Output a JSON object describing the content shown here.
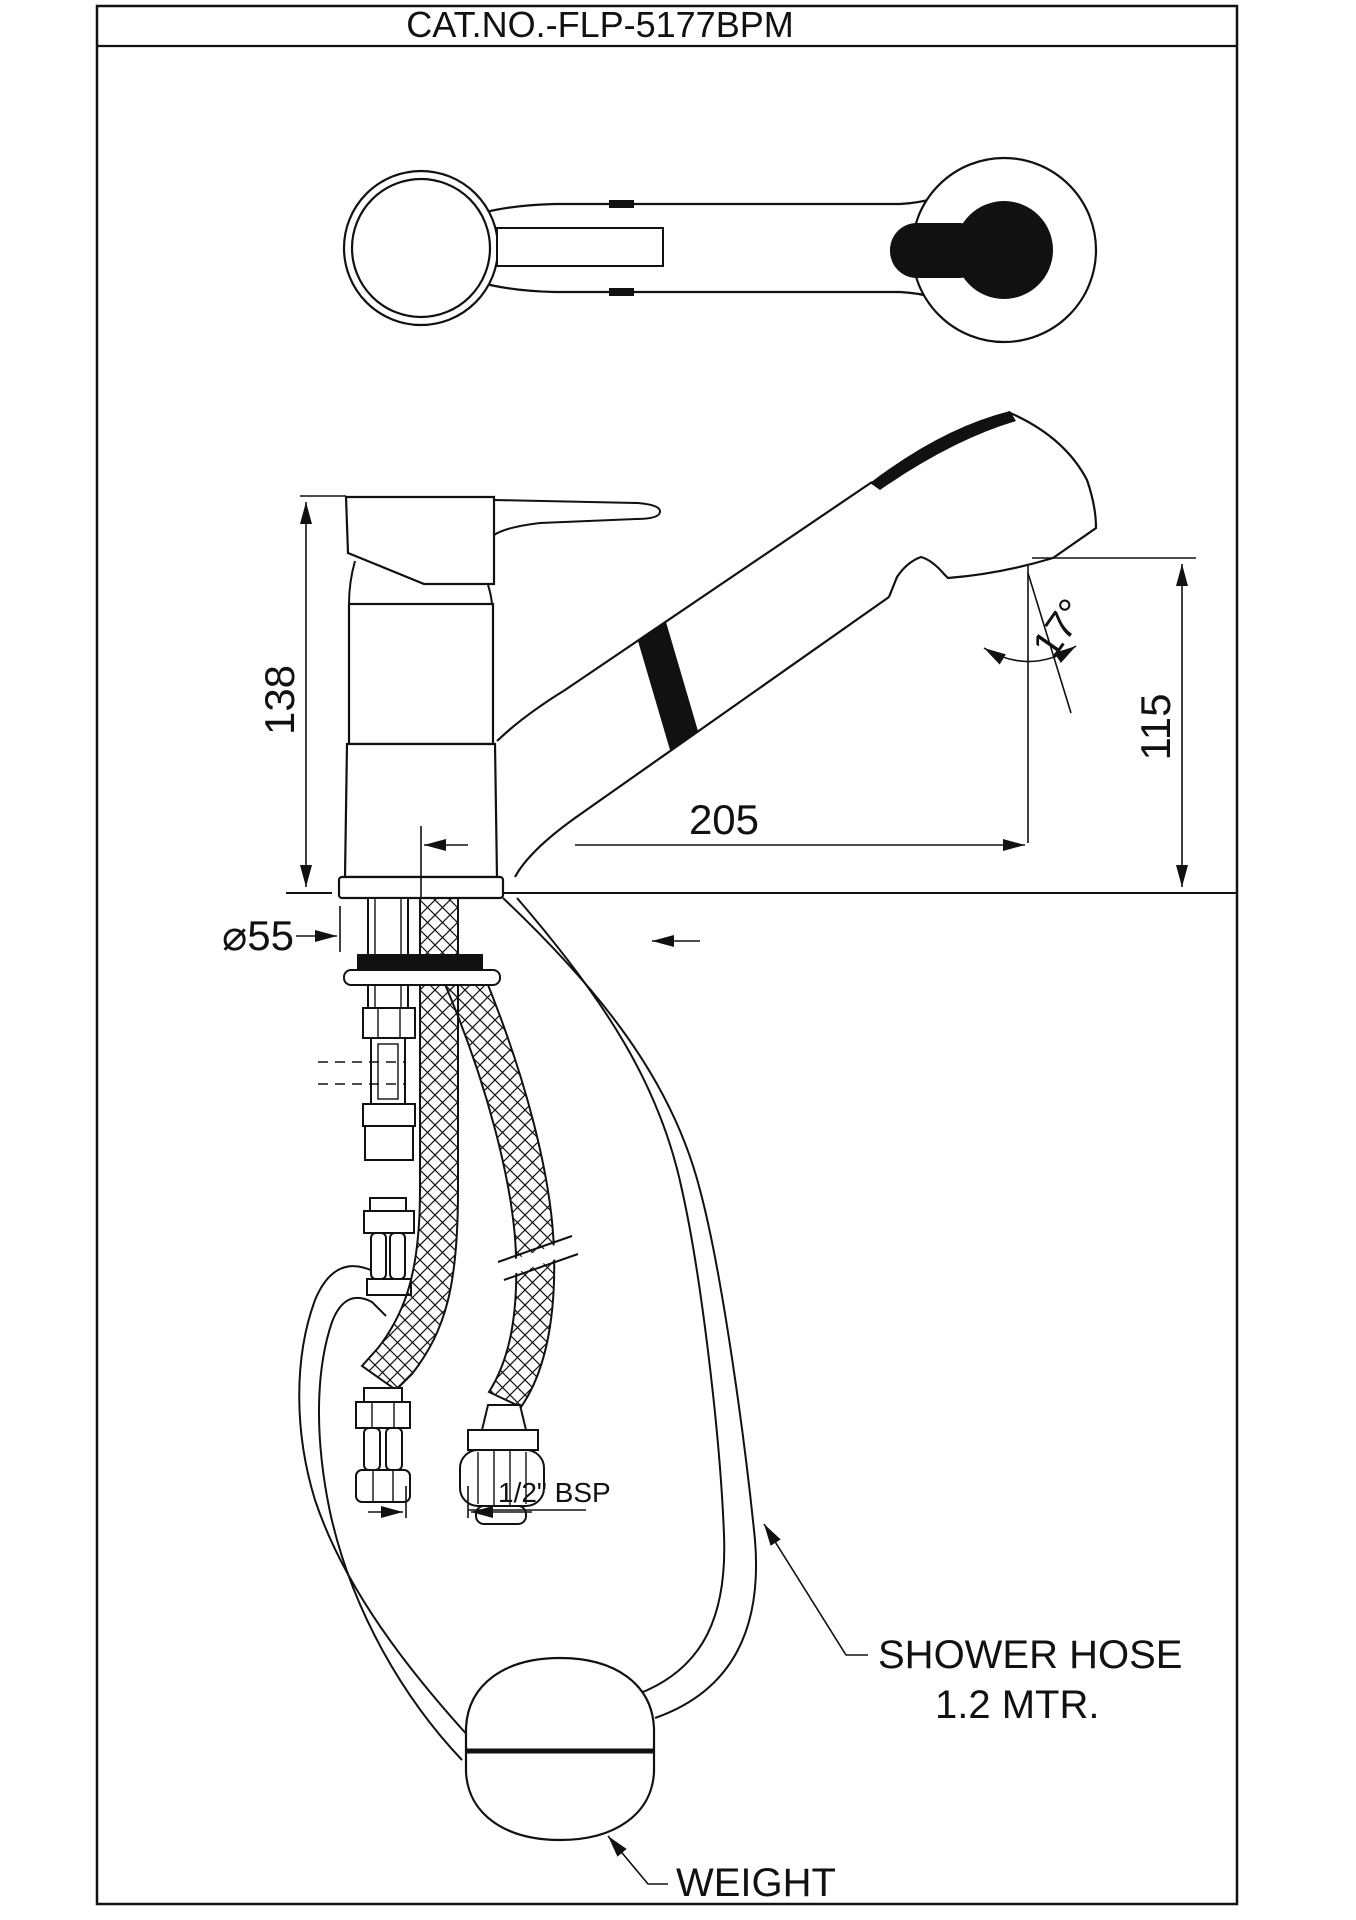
{
  "title": "CAT.NO.-FLP-5177BPM",
  "dimensions": {
    "body_height": "138",
    "spout_reach": "205",
    "spout_height": "115",
    "spray_angle": "17°",
    "base_diameter": "⌀55",
    "connection_thread": "1/2\" BSP"
  },
  "labels": {
    "shower_hose_line1": "SHOWER HOSE",
    "shower_hose_line2": "1.2 MTR.",
    "weight": "WEIGHT"
  },
  "colors": {
    "line": "#111111",
    "background": "#ffffff"
  }
}
